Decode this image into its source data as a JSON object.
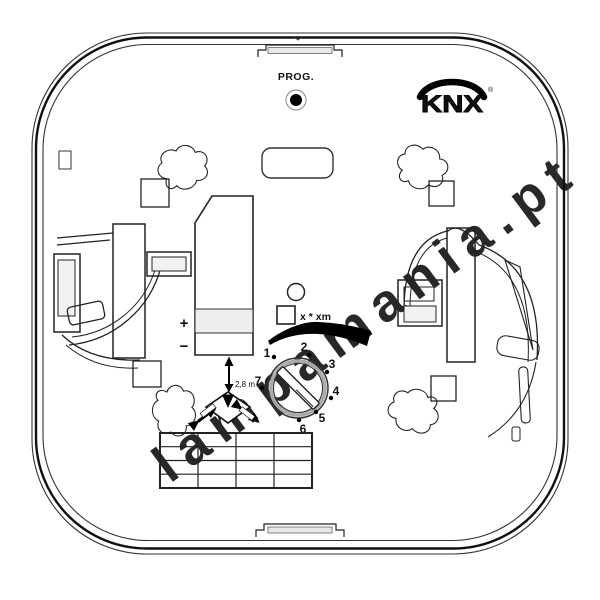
{
  "colors": {
    "line": "#1a1a1a",
    "panel_gray": "#ededed",
    "watermark_gray": "#d6d6d6"
  },
  "watermark": {
    "text": "lampamania.pt"
  },
  "device": {
    "prog_label": "PROG.",
    "logo": {
      "text": "KNX",
      "registered_mark": "®"
    },
    "terminal": {
      "plus_label": "+",
      "minus_label": "−"
    },
    "indicator_label": "x * xm",
    "mounting_height_label": "2,8 m",
    "dial": {
      "numbers": [
        "1",
        "2",
        "3",
        "4",
        "5",
        "6",
        "7"
      ]
    },
    "dip_table": {
      "rows": 4,
      "columns": 4
    }
  }
}
